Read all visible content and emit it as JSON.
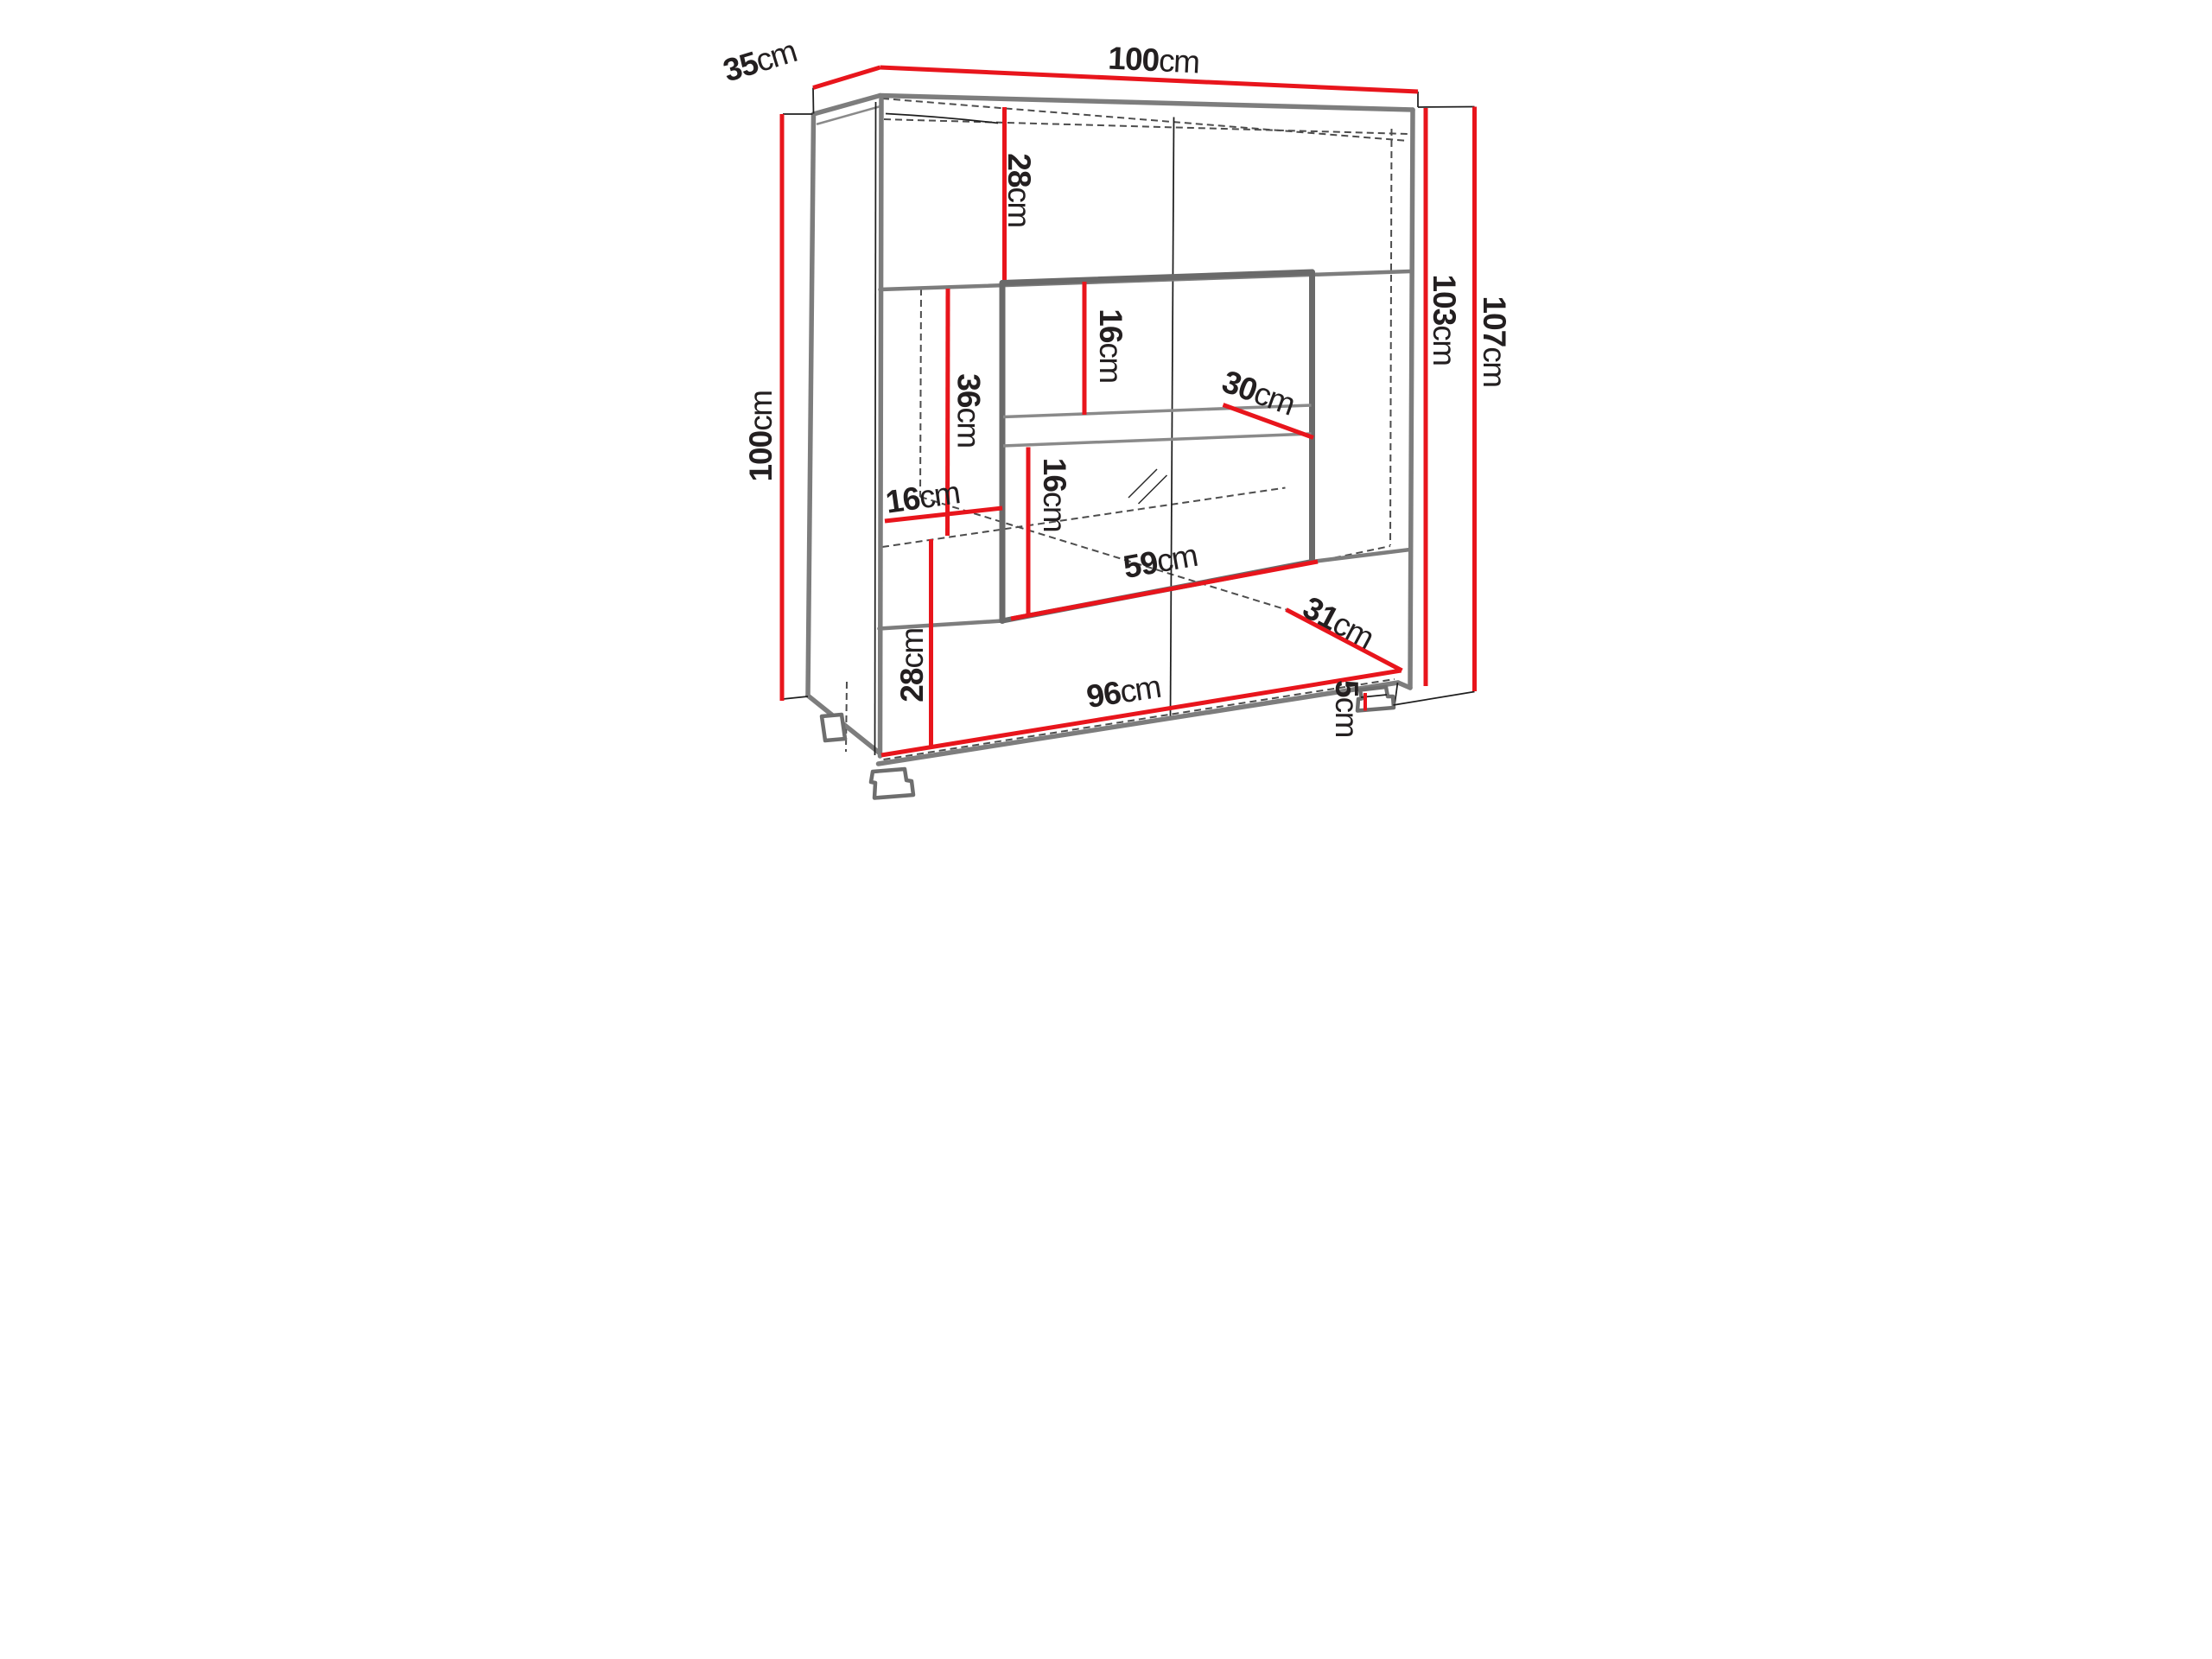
{
  "diagram": {
    "kind": "furniture-dimension-drawing",
    "subject": "display cabinet with glass showcase, shelves and legs",
    "unit": "cm",
    "colors": {
      "dimension_line": "#e8151c",
      "outline": "#7d7d7d",
      "hidden_edge": "#4d4d4d",
      "label_text": "#231f20",
      "background": "#ffffff"
    },
    "dimensions": {
      "depth_top": {
        "value": "35",
        "unit": "cm"
      },
      "width_top": {
        "value": "100",
        "unit": "cm"
      },
      "height_left": {
        "value": "100",
        "unit": "cm"
      },
      "height_inner_right": {
        "value": "103",
        "unit": "cm"
      },
      "height_total_right": {
        "value": "107",
        "unit": "cm"
      },
      "top_section_height": {
        "value": "28",
        "unit": "cm"
      },
      "middle_section_height": {
        "value": "36",
        "unit": "cm"
      },
      "inner_upper_height": {
        "value": "16",
        "unit": "cm"
      },
      "shelf_depth": {
        "value": "30",
        "unit": "cm"
      },
      "inner_lower_height": {
        "value": "16",
        "unit": "cm"
      },
      "side_inset_depth": {
        "value": "16",
        "unit": "cm"
      },
      "display_width": {
        "value": "59",
        "unit": "cm"
      },
      "bottom_section_height": {
        "value": "28",
        "unit": "cm"
      },
      "bottom_depth": {
        "value": "31",
        "unit": "cm"
      },
      "bottom_width": {
        "value": "96",
        "unit": "cm"
      },
      "leg_height": {
        "value": "5",
        "unit": "cm"
      }
    }
  }
}
